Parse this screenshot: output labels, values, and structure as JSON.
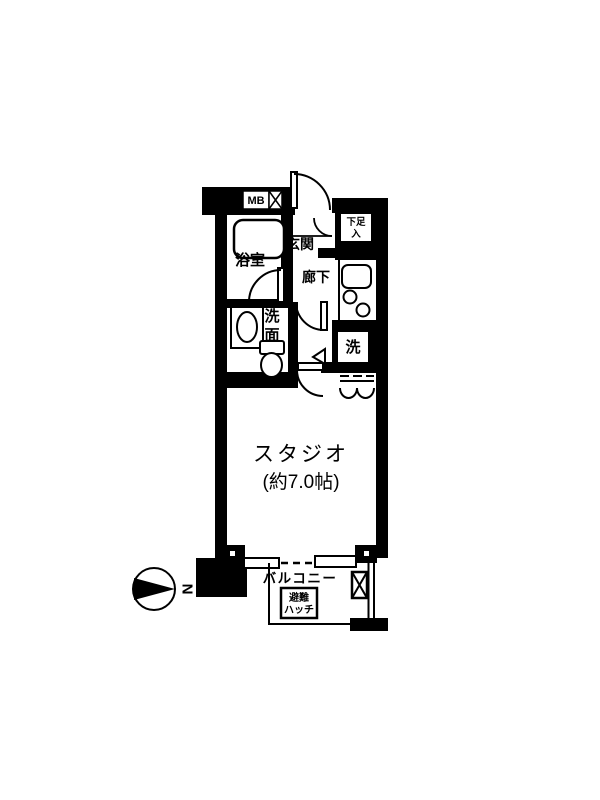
{
  "floor_plan": {
    "type": "apartment-floor-plan",
    "labels": {
      "bath": "浴室",
      "entrance": "玄関",
      "hallway": "廊下",
      "washroom_l1": "洗",
      "washroom_l2": "面",
      "laundry": "洗",
      "meter_box": "MB",
      "pipe_space": "P.S",
      "shoe_l1": "下足",
      "shoe_l2": "入",
      "studio_name": "スタジオ",
      "studio_size": "(約7.0帖)",
      "balcony": "バルコニー",
      "hatch_l1": "避難",
      "hatch_l2": "ハッチ",
      "compass_north": "N"
    },
    "colors": {
      "wall": "#000000",
      "background": "#ffffff"
    }
  }
}
